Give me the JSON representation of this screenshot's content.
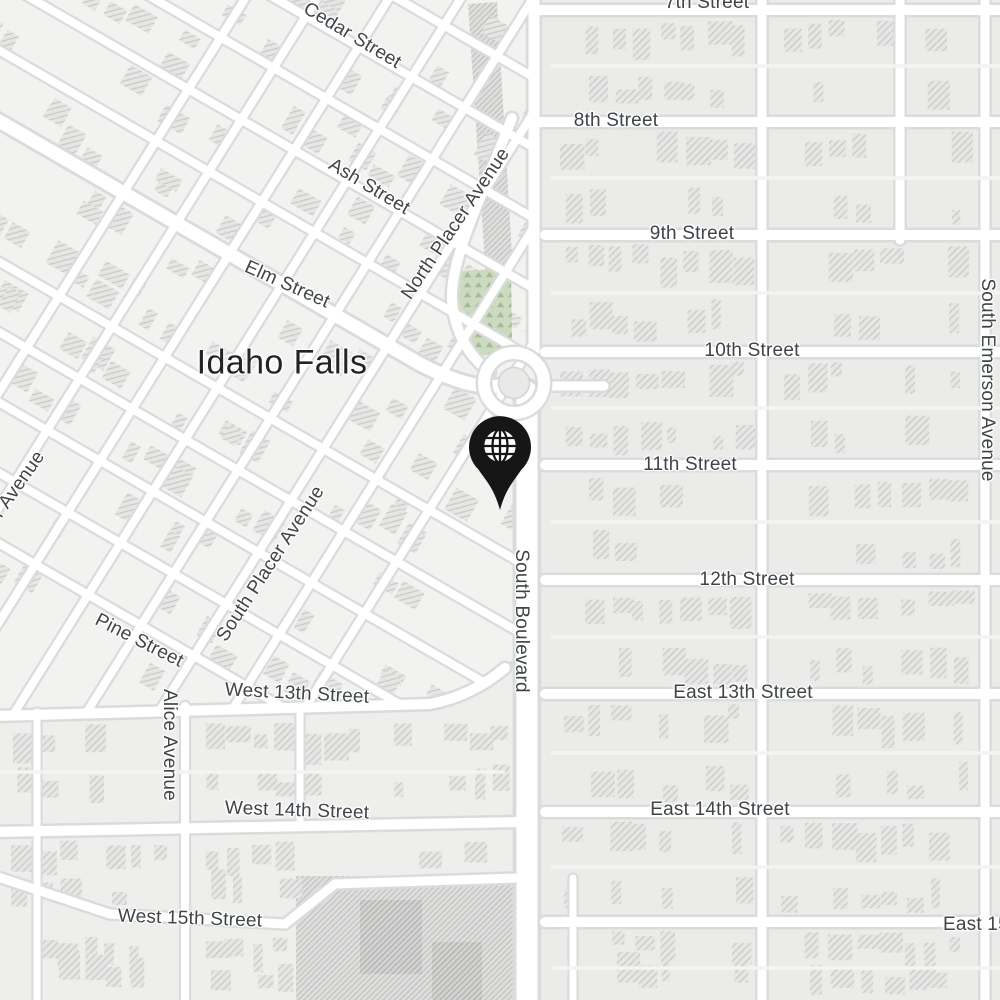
{
  "app": {
    "type": "map-view",
    "view_city": "Idaho Falls"
  },
  "map": {
    "city_label": "Idaho Falls",
    "marker": {
      "name": "location-pin",
      "glyph": "globe"
    },
    "colors": {
      "background": "#eeeeec",
      "block": "#ebebe9",
      "downtown_block": "#f2f2f0",
      "road": "#ffffff",
      "road_casing": "#d9dcdb",
      "alley": "#f4f4f2",
      "building_fill": "#e6e6e4",
      "building_hatch": "#c7c9c8",
      "dense_fill": "#dfdfdd",
      "dense_hatch": "#bfc1c0",
      "park": "#ccdabf",
      "park_texture": "#a4bb98",
      "roundabout_island": "#e9e9e7",
      "street_label": "#3f4449",
      "city_label": "#212427",
      "pin": "#161616",
      "pin_glyph": "#ffffff"
    },
    "street_labels": [
      {
        "id": "cedar-street",
        "text": "Cedar Street"
      },
      {
        "id": "7th-street",
        "text": "7th Street"
      },
      {
        "id": "8th-street",
        "text": "8th Street"
      },
      {
        "id": "ash-street",
        "text": "Ash Street"
      },
      {
        "id": "north-placer-avenue",
        "text": "North Placer Avenue"
      },
      {
        "id": "9th-street",
        "text": "9th Street"
      },
      {
        "id": "elm-street",
        "text": "Elm Street"
      },
      {
        "id": "10th-street",
        "text": "10th Street"
      },
      {
        "id": "south-emerson-avenue",
        "text": "South Emerson Avenue"
      },
      {
        "id": "11th-street",
        "text": "11th Street"
      },
      {
        "id": "south-boulevard",
        "text": "South Boulevard"
      },
      {
        "id": "south-placer-avenue",
        "text": "South Placer Avenue"
      },
      {
        "id": "12th-street",
        "text": "12th Street"
      },
      {
        "id": "placer-avenue-partial",
        "text": "er Avenue"
      },
      {
        "id": "pine-street",
        "text": "Pine Street"
      },
      {
        "id": "west-13th-street",
        "text": "West 13th Street"
      },
      {
        "id": "east-13th-street",
        "text": "East 13th Street"
      },
      {
        "id": "alice-avenue",
        "text": "Alice Avenue"
      },
      {
        "id": "west-14th-street",
        "text": "West 14th Street"
      },
      {
        "id": "east-14th-street",
        "text": "East 14th Street"
      },
      {
        "id": "west-15th-street",
        "text": "West 15th Street"
      },
      {
        "id": "east-15th-street",
        "text": "East 15th Street"
      }
    ]
  }
}
